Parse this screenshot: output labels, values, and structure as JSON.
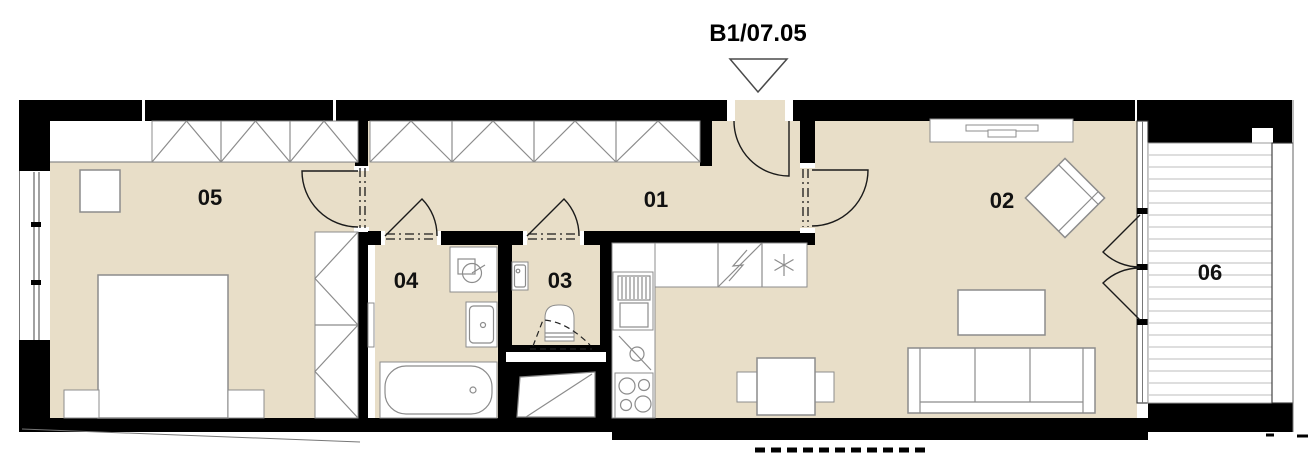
{
  "unit_label": "B1/07.05",
  "rooms": {
    "r05": {
      "label": "05"
    },
    "r01": {
      "label": "01"
    },
    "r04": {
      "label": "04"
    },
    "r03": {
      "label": "03"
    },
    "r02": {
      "label": "02"
    },
    "r06": {
      "label": "06"
    }
  },
  "colors": {
    "floor": "#e8dec8",
    "wall": "#000000",
    "furniture_line": "#8c8c8c",
    "label": "#111111"
  },
  "icons": {
    "entrance_marker": "triangle-down",
    "electrical_panel": "lightning-bolt",
    "fridge": "asterisk-snowflake",
    "washing_machine": "circle-drum",
    "sink_tap": "circle-with-lever",
    "cooktop": "four-burners"
  }
}
